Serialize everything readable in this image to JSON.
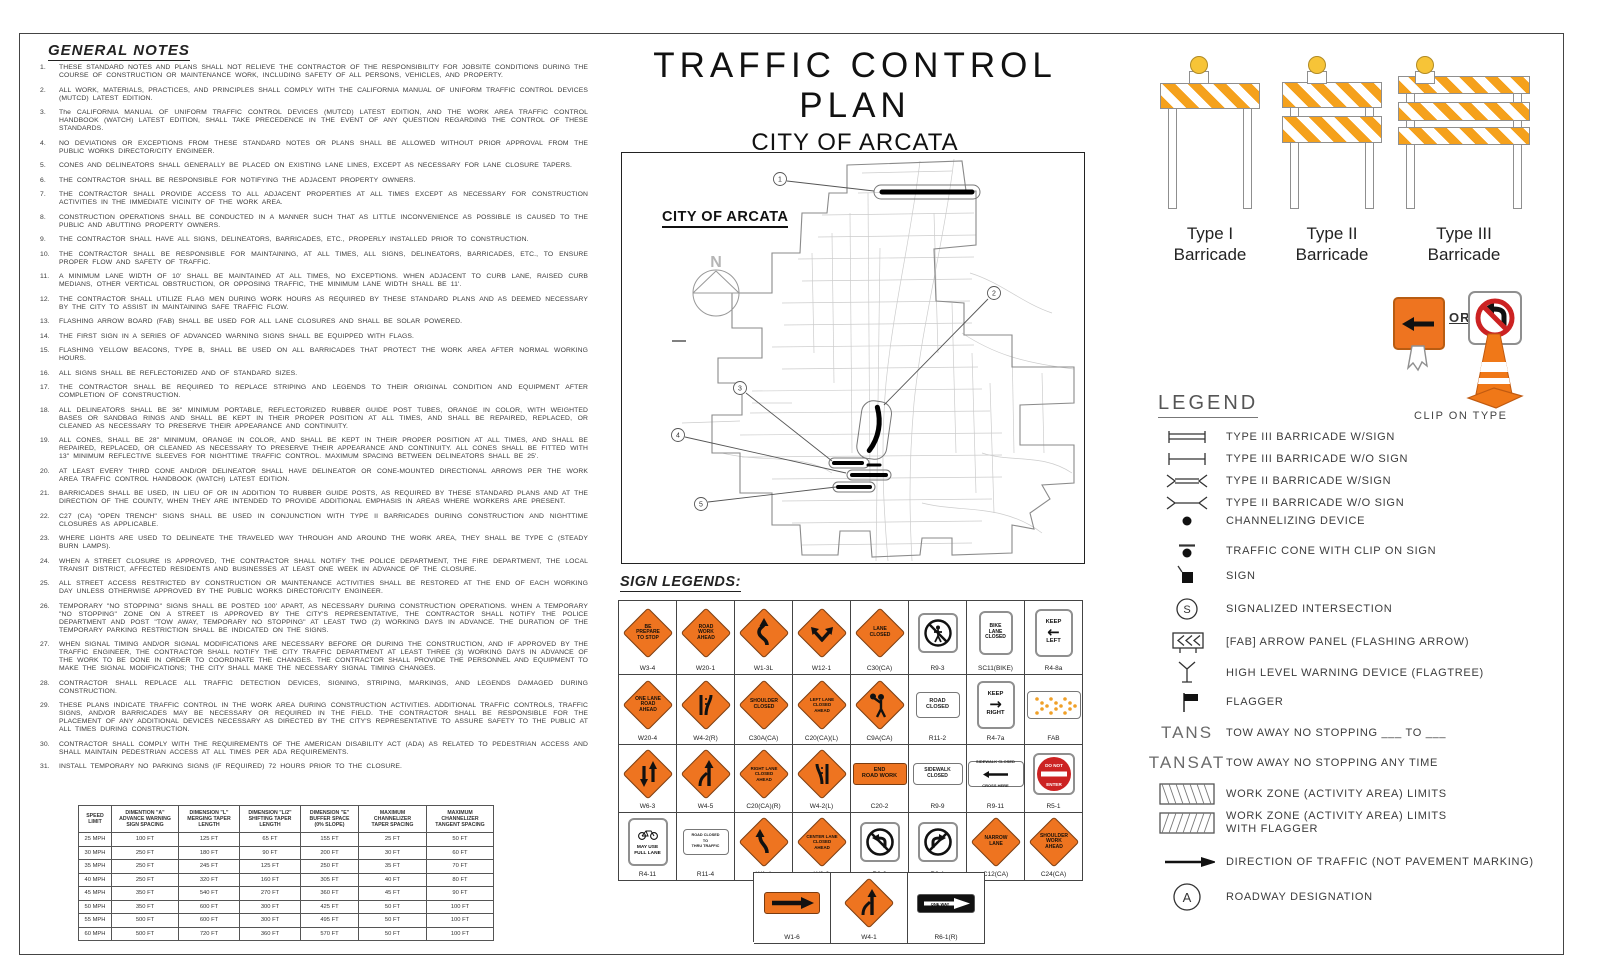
{
  "title": {
    "line1": "TRAFFIC CONTROL PLAN",
    "line2": "CITY OF ARCATA",
    "line3": "2025 JOINT SLURRY PROJECT"
  },
  "general_notes": {
    "heading": "GENERAL NOTES",
    "notes": [
      "THESE STANDARD NOTES AND PLANS SHALL NOT RELIEVE THE CONTRACTOR OF THE RESPONSIBILITY FOR JOBSITE CONDITIONS DURING THE COURSE OF CONSTRUCTION OR MAINTENANCE WORK, INCLUDING SAFETY OF ALL PERSONS, VEHICLES, AND PROPERTY.",
      "ALL WORK, MATERIALS, PRACTICES, AND PRINCIPLES SHALL COMPLY WITH THE CALIFORNIA MANUAL OF UNIFORM TRAFFIC CONTROL DEVICES (MUTCD) LATEST EDITION.",
      "The CALIFORNIA MANUAL OF UNIFORM TRAFFIC CONTROL DEVICES (MUTCD) LATEST EDITION, AND THE WORK AREA TRAFFIC CONTROL HANDBOOK (WATCH) LATEST EDITION, SHALL TAKE PRECEDENCE IN THE EVENT OF ANY QUESTION REGARDING THE CONTROL OF THESE STANDARDS.",
      "NO DEVIATIONS OR EXCEPTIONS FROM THESE STANDARD NOTES OR PLANS SHALL BE ALLOWED WITHOUT PRIOR APPROVAL FROM THE PUBLIC WORKS DIRECTOR/CITY ENGINEER.",
      "CONES AND DELINEATORS SHALL GENERALLY BE PLACED ON EXISTING LANE LINES, EXCEPT AS NECESSARY FOR LANE CLOSURE TAPERS.",
      "THE CONTRACTOR SHALL BE RESPONSIBLE FOR NOTIFYING THE ADJACENT PROPERTY OWNERS.",
      "THE CONTRACTOR SHALL PROVIDE ACCESS TO ALL ADJACENT PROPERTIES AT ALL TIMES EXCEPT AS NECESSARY FOR CONSTRUCTION ACTIVITIES IN THE IMMEDIATE VICINITY OF THE WORK AREA.",
      "CONSTRUCTION OPERATIONS SHALL BE CONDUCTED IN A MANNER SUCH THAT AS LITTLE INCONVENIENCE AS POSSIBLE IS CAUSED TO THE PUBLIC AND ABUTTING PROPERTY OWNERS.",
      "THE CONTRACTOR SHALL HAVE ALL SIGNS, DELINEATORS, BARRICADES, ETC., PROPERLY INSTALLED PRIOR TO CONSTRUCTION.",
      "THE CONTRACTOR SHALL BE RESPONSIBLE FOR MAINTAINING, AT ALL TIMES, ALL SIGNS, DELINEATORS, BARRICADES, ETC., TO ENSURE PROPER FLOW AND SAFETY OF TRAFFIC.",
      "A MINIMUM LANE WIDTH OF 10' SHALL BE MAINTAINED AT ALL TIMES, NO EXCEPTIONS. WHEN ADJACENT TO CURB LANE, RAISED CURB MEDIANS, OTHER VERTICAL OBSTRUCTION, OR OPPOSING TRAFFIC, THE MINIMUM LANE WIDTH SHALL BE 11'.",
      "THE CONTRACTOR SHALL UTILIZE FLAG MEN DURING WORK HOURS AS REQUIRED BY THESE STANDARD PLANS AND AS DEEMED NECESSARY BY THE CITY TO ASSIST IN MAINTAINING SAFE TRAFFIC FLOW.",
      "FLASHING ARROW BOARD (FAB) SHALL BE USED FOR ALL LANE CLOSURES AND SHALL BE SOLAR POWERED.",
      "THE FIRST SIGN IN A SERIES OF ADVANCED WARNING SIGNS SHALL BE EQUIPPED WITH FLAGS.",
      "FLASHING YELLOW BEACONS, TYPE B, SHALL BE USED ON ALL BARRICADES THAT PROTECT THE WORK AREA AFTER NORMAL WORKING HOURS.",
      "ALL SIGNS SHALL BE REFLECTORIZED AND OF STANDARD SIZES.",
      "THE CONTRACTOR SHALL BE REQUIRED TO REPLACE STRIPING AND LEGENDS TO THEIR ORIGINAL CONDITION AND EQUIPMENT AFTER COMPLETION OF CONSTRUCTION.",
      "ALL DELINEATORS SHALL BE 36\" MINIMUM PORTABLE, REFLECTORIZED RUBBER GUIDE POST TUBES, ORANGE IN COLOR, WITH WEIGHTED BASES OR SANDBAG RINGS AND SHALL BE KEPT IN THEIR PROPER POSITION AT ALL TIMES, AND SHALL BE REPAIRED, REPLACED, OR CLEANED AS NECESSARY TO PRESERVE THEIR APPEARANCE AND CONTINUITY.",
      "ALL CONES, SHALL BE 28\" MINIMUM, ORANGE IN COLOR, AND SHALL BE KEPT IN THEIR PROPER POSITION AT ALL TIMES, AND SHALL BE REPAIRED, REPLACED, OR CLEANED AS NECESSARY TO PRESERVE THEIR APPEARANCE AND CONTINUITY. ALL CONES SHALL BE FITTED WITH 13\" MINIMUM REFLECTIVE SLEEVES FOR NIGHTTIME TRAFFIC CONTROL. MAXIMUM SPACING BETWEEN DELINEATORS SHALL BE 25'.",
      "AT LEAST EVERY THIRD CONE AND/OR DELINEATOR SHALL HAVE DELINEATOR OR CONE-MOUNTED DIRECTIONAL ARROWS PER THE WORK AREA TRAFFIC CONTROL HANDBOOK (WATCH) LATEST EDITION.",
      "BARRICADES SHALL BE USED, IN LIEU OF OR IN ADDITION TO RUBBER GUIDE POSTS, AS REQUIRED BY THESE STANDARD PLANS AND AT THE DIRECTION OF THE COUNTY, WHEN THEY ARE INTENDED TO PROVIDE ADDITIONAL EMPHASIS IN AREAS WHERE WORKERS ARE PRESENT.",
      "C27 (CA) \"OPEN TRENCH\" SIGNS SHALL BE USED IN CONJUNCTION WITH TYPE II BARRICADES DURING CONSTRUCTION AND NIGHTTIME CLOSURES AS APPLICABLE.",
      "WHERE LIGHTS ARE USED TO DELINEATE THE TRAVELED WAY THROUGH AND AROUND THE WORK AREA, THEY SHALL BE TYPE C (STEADY BURN LAMPS).",
      "WHEN A STREET CLOSURE IS APPROVED, THE CONTRACTOR SHALL NOTIFY THE POLICE DEPARTMENT, THE FIRE DEPARTMENT, THE LOCAL TRANSIT DISTRICT, AFFECTED RESIDENTS AND BUSINESSES AT LEAST ONE WEEK IN ADVANCE OF THE CLOSURE.",
      "ALL STREET ACCESS RESTRICTED BY CONSTRUCTION OR MAINTENANCE ACTIVITIES SHALL BE RESTORED AT THE END OF EACH WORKING DAY UNLESS OTHERWISE APPROVED BY THE PUBLIC WORKS DIRECTOR/CITY ENGINEER.",
      "TEMPORARY \"NO STOPPING\" SIGNS SHALL BE POSTED 100' APART, AS NECESSARY DURING CONSTRUCTION OPERATIONS. WHEN A TEMPORARY \"NO STOPPING\" ZONE ON A STREET IS APPROVED BY THE CITY'S REPRESENTATIVE, THE CONTRACTOR SHALL NOTIFY THE POLICE DEPARTMENT AND POST \"TOW AWAY, TEMPORARY NO STOPPING\" AT LEAST TWO (2) WORKING DAYS IN ADVANCE. THE DURATION OF THE TEMPORARY PARKING RESTRICTION SHALL BE INDICATED ON THE SIGNS.",
      "WHEN SIGNAL TIMING AND/OR SIGNAL MODIFICATIONS ARE NECESSARY BEFORE OR DURING THE CONSTRUCTION, AND IF APPROVED BY THE TRAFFIC ENGINEER, THE CONTRACTOR SHALL NOTIFY THE CITY TRAFFIC DEPARTMENT AT LEAST THREE (3) WORKING DAYS IN ADVANCE OF THE WORK TO BE DONE IN ORDER TO COORDINATE THE CHANGES. THE CONTRACTOR SHALL PROVIDE THE PERSONNEL AND EQUIPMENT TO MAKE THE SIGNAL MODIFICATIONS; THE CITY SHALL MAKE THE NECESSARY SIGNAL TIMING CHANGES.",
      "CONTRACTOR SHALL REPLACE ALL TRAFFIC DETECTION DEVICES, SIGNING, STRIPING, MARKINGS, AND LEGENDS DAMAGED DURING CONSTRUCTION.",
      "THESE PLANS INDICATE TRAFFIC CONTROL IN THE WORK AREA DURING CONSTRUCTION ACTIVITIES. ADDITIONAL TRAFFIC CONTROLS, TRAFFIC SIGNS, AND/OR BARRICADES MAY BE NECESSARY OR REQUIRED IN THE FIELD. THE CONTRACTOR SHALL BE RESPONSIBLE FOR THE PLACEMENT OF ANY ADDITIONAL DEVICES NECESSARY AS DIRECTED BY THE CITY'S REPRESENTATIVE TO ASSURE SAFETY TO THE PUBLIC AT ALL TIMES DURING CONSTRUCTION.",
      "CONTRACTOR SHALL COMPLY WITH THE REQUIREMENTS OF THE AMERICAN DISABILITY ACT (ADA) AS RELATED TO PEDESTRIAN ACCESS AND SHALL MAINTAIN PEDESTRIAN ACCESS AT ALL TIMES PER ADA REQUIREMENTS.",
      "INSTALL TEMPORARY NO PARKING SIGNS (IF REQUIRED) 72 HOURS PRIOR TO THE CLOSURE."
    ]
  },
  "spacing_table": {
    "headers": [
      "SPEED\nLIMIT",
      "DIMENTION \"A\"\nADVANCE WARNING\nSIGN SPACING",
      "DIMENSION \"L\"\nMERGING TAPER\nLENGTH",
      "DIMENSION \"L/2\"\nSHIFTING TAPER\nLENGTH",
      "DIMENSION \"E\"\nBUFFER SPACE\n(0% SLOPE)",
      "MAXIMUM\nCHANNELIZER\nTAPER SPACING",
      "MAXIMUM\nCHANNELIZER\nTANGENT SPACING"
    ],
    "rows": [
      [
        "25 MPH",
        "100 FT",
        "125 FT",
        "65 FT",
        "155 FT",
        "25 FT",
        "50 FT"
      ],
      [
        "30 MPH",
        "250 FT",
        "180 FT",
        "90 FT",
        "200 FT",
        "30 FT",
        "60 FT"
      ],
      [
        "35 MPH",
        "250 FT",
        "245 FT",
        "125 FT",
        "250 FT",
        "35 FT",
        "70 FT"
      ],
      [
        "40 MPH",
        "250 FT",
        "320 FT",
        "160 FT",
        "305 FT",
        "40 FT",
        "80 FT"
      ],
      [
        "45 MPH",
        "350 FT",
        "540 FT",
        "270 FT",
        "360 FT",
        "45 FT",
        "90 FT"
      ],
      [
        "50 MPH",
        "350 FT",
        "600 FT",
        "300 FT",
        "425 FT",
        "50 FT",
        "100 FT"
      ],
      [
        "55 MPH",
        "500 FT",
        "600 FT",
        "300 FT",
        "495 FT",
        "50 FT",
        "100 FT"
      ],
      [
        "60 MPH",
        "500 FT",
        "720 FT",
        "360 FT",
        "570 FT",
        "50 FT",
        "100 FT"
      ]
    ]
  },
  "map": {
    "label": "CITY OF ARCATA",
    "north_label": "N",
    "callouts": [
      "1",
      "2",
      "3",
      "4",
      "5"
    ]
  },
  "barricades": [
    {
      "label": "Type I\nBarricade",
      "boards": 1
    },
    {
      "label": "Type II\nBarricade",
      "boards": 2
    },
    {
      "label": "Type III\nBarricade",
      "boards": 3
    }
  ],
  "clip_on": {
    "or_label": "OR",
    "caption": "CLIP ON TYPE"
  },
  "sign_legends": {
    "heading": "SIGN LEGENDS:",
    "rows": [
      [
        {
          "id": "W3-4",
          "kind": "diamond",
          "lines": [
            "BE",
            "PREPARE",
            "TO STOP"
          ]
        },
        {
          "id": "W20-1",
          "kind": "diamond",
          "lines": [
            "ROAD",
            "WORK",
            "AHEAD"
          ]
        },
        {
          "id": "W1-3L",
          "kind": "diamond",
          "glyph": "reverse-curve"
        },
        {
          "id": "W12-1",
          "kind": "diamond",
          "glyph": "double-arrow"
        },
        {
          "id": "C30(CA)",
          "kind": "diamond",
          "lines": [
            "LANE",
            "CLOSED"
          ]
        },
        {
          "id": "R9-3",
          "kind": "white-sq",
          "glyph": "no-ped"
        },
        {
          "id": "SC11(BIKE)",
          "kind": "white-sq-text",
          "lines": [
            "BIKE",
            "LANE",
            "CLOSED"
          ]
        },
        {
          "id": "R4-8a",
          "kind": "keep",
          "arrow": "left",
          "word": "LEFT",
          "keep": "KEEP"
        }
      ],
      [
        {
          "id": "W20-4",
          "kind": "diamond",
          "lines": [
            "ONE LANE",
            "ROAD",
            "AHEAD"
          ]
        },
        {
          "id": "W4-2(R)",
          "kind": "diamond",
          "glyph": "lane-ends-right"
        },
        {
          "id": "C30A(CA)",
          "kind": "diamond",
          "lines": [
            "SHOULDER",
            "CLOSED"
          ]
        },
        {
          "id": "C20(CA)(L)",
          "kind": "diamond",
          "lines": [
            "LEFT LANE",
            "CLOSED",
            "AHEAD"
          ]
        },
        {
          "id": "C9A(CA)",
          "kind": "diamond",
          "glyph": "flagger"
        },
        {
          "id": "R11-2",
          "kind": "white-rect",
          "lines": [
            "ROAD",
            "CLOSED"
          ],
          "w": 44,
          "h": 26,
          "fs": 5.5
        },
        {
          "id": "R4-7a",
          "kind": "keep",
          "arrow": "right",
          "word": "RIGHT",
          "keep": "KEEP"
        },
        {
          "id": "FAB",
          "kind": "fab"
        }
      ],
      [
        {
          "id": "W6-3",
          "kind": "diamond",
          "glyph": "two-way"
        },
        {
          "id": "W4-5",
          "kind": "diamond",
          "glyph": "merge"
        },
        {
          "id": "C20(CA)(R)",
          "kind": "diamond",
          "lines": [
            "RIGHT LANE",
            "CLOSED",
            "AHEAD"
          ]
        },
        {
          "id": "W4-2(L)",
          "kind": "diamond",
          "glyph": "lane-ends-left"
        },
        {
          "id": "C20-2",
          "kind": "orange-rect",
          "lines": [
            "END",
            "ROAD WORK"
          ]
        },
        {
          "id": "R9-9",
          "kind": "white-rect",
          "lines": [
            "SIDEWALK",
            "CLOSED"
          ],
          "w": 50,
          "h": 22,
          "fs": 5
        },
        {
          "id": "R9-11",
          "kind": "r9-11",
          "lines": [
            "SIDEWALK CLOSED",
            "CROSS HERE"
          ]
        },
        {
          "id": "R5-1",
          "kind": "do-not-enter",
          "lines": [
            "DO NOT",
            "ENTER"
          ]
        }
      ],
      [
        {
          "id": "R4-11",
          "kind": "may-use",
          "lines": [
            "MAY USE",
            "FULL LANE"
          ]
        },
        {
          "id": "R11-4",
          "kind": "white-rect",
          "lines": [
            "ROAD CLOSED",
            "TO",
            "THRU TRAFFIC"
          ],
          "w": 46,
          "h": 26,
          "fs": 3.8
        },
        {
          "id": "W1-4",
          "kind": "diamond",
          "glyph": "curve-left"
        },
        {
          "id": "W9-3",
          "kind": "diamond",
          "lines": [
            "CENTER LANE",
            "CLOSED",
            "AHEAD"
          ]
        },
        {
          "id": "R3-2",
          "kind": "white-sq",
          "glyph": "no-left-turn"
        },
        {
          "id": "R3-1",
          "kind": "white-sq",
          "glyph": "no-right-turn"
        },
        {
          "id": "C12(CA)",
          "kind": "diamond",
          "lines": [
            "NARROW",
            "LANE"
          ]
        },
        {
          "id": "C24(CA)",
          "kind": "diamond",
          "lines": [
            "SHOULDER",
            "WORK",
            "AHEAD"
          ]
        }
      ]
    ],
    "extra_row": [
      {
        "id": "W1-6",
        "kind": "orange-arrow"
      },
      {
        "id": "W4-1",
        "kind": "diamond",
        "glyph": "merge"
      },
      {
        "id": "R6-1(R)",
        "kind": "one-way",
        "lines": [
          "ONE WAY"
        ]
      }
    ]
  },
  "legend": {
    "heading": "LEGEND",
    "items": [
      {
        "symbol": "t3s",
        "label": "TYPE III BARRICADE W/SIGN"
      },
      {
        "symbol": "t3",
        "label": "TYPE III BARRICADE W/O SIGN"
      },
      {
        "symbol": "t2s",
        "label": "TYPE II BARRICADE W/SIGN"
      },
      {
        "symbol": "t2",
        "label": "TYPE II BARRICADE W/O SIGN"
      },
      {
        "symbol": "dot",
        "label": "CHANNELIZING DEVICE"
      },
      {
        "symbol": "dotbar",
        "label": "TRAFFIC CONE WITH CLIP ON SIGN"
      },
      {
        "symbol": "sqr",
        "label": "SIGN"
      },
      {
        "symbol": "circS",
        "label": "SIGNALIZED INTERSECTION"
      },
      {
        "symbol": "fabsym",
        "label": "[FAB] ARROW PANEL (FLASHING ARROW)"
      },
      {
        "symbol": "flagtree",
        "label": "HIGH LEVEL WARNING DEVICE (FLAGTREE)"
      },
      {
        "symbol": "flag",
        "label": "FLAGGER"
      },
      {
        "symtext": "TANS",
        "label": "TOW AWAY NO STOPPING ___ TO ___"
      },
      {
        "symtext": "TANSAT",
        "label": "TOW AWAY NO STOPPING ANY TIME"
      },
      {
        "symbol": "hatch1",
        "label": "WORK ZONE (ACTIVITY AREA) LIMITS"
      },
      {
        "symbol": "hatch2",
        "label": "WORK ZONE (ACTIVITY AREA) LIMITS\nWITH FLAGGER"
      },
      {
        "symbol": "dirarrow",
        "label": "DIRECTION OF TRAFFIC (NOT PAVEMENT MARKING)"
      },
      {
        "symbol": "circA",
        "label": "ROADWAY DESIGNATION"
      }
    ]
  },
  "colors": {
    "sign_orange": "#EE7420",
    "barricade_orange": "#F5A11C",
    "lamp_yellow": "#F7C437",
    "do_not_enter_red": "#CC2222"
  }
}
